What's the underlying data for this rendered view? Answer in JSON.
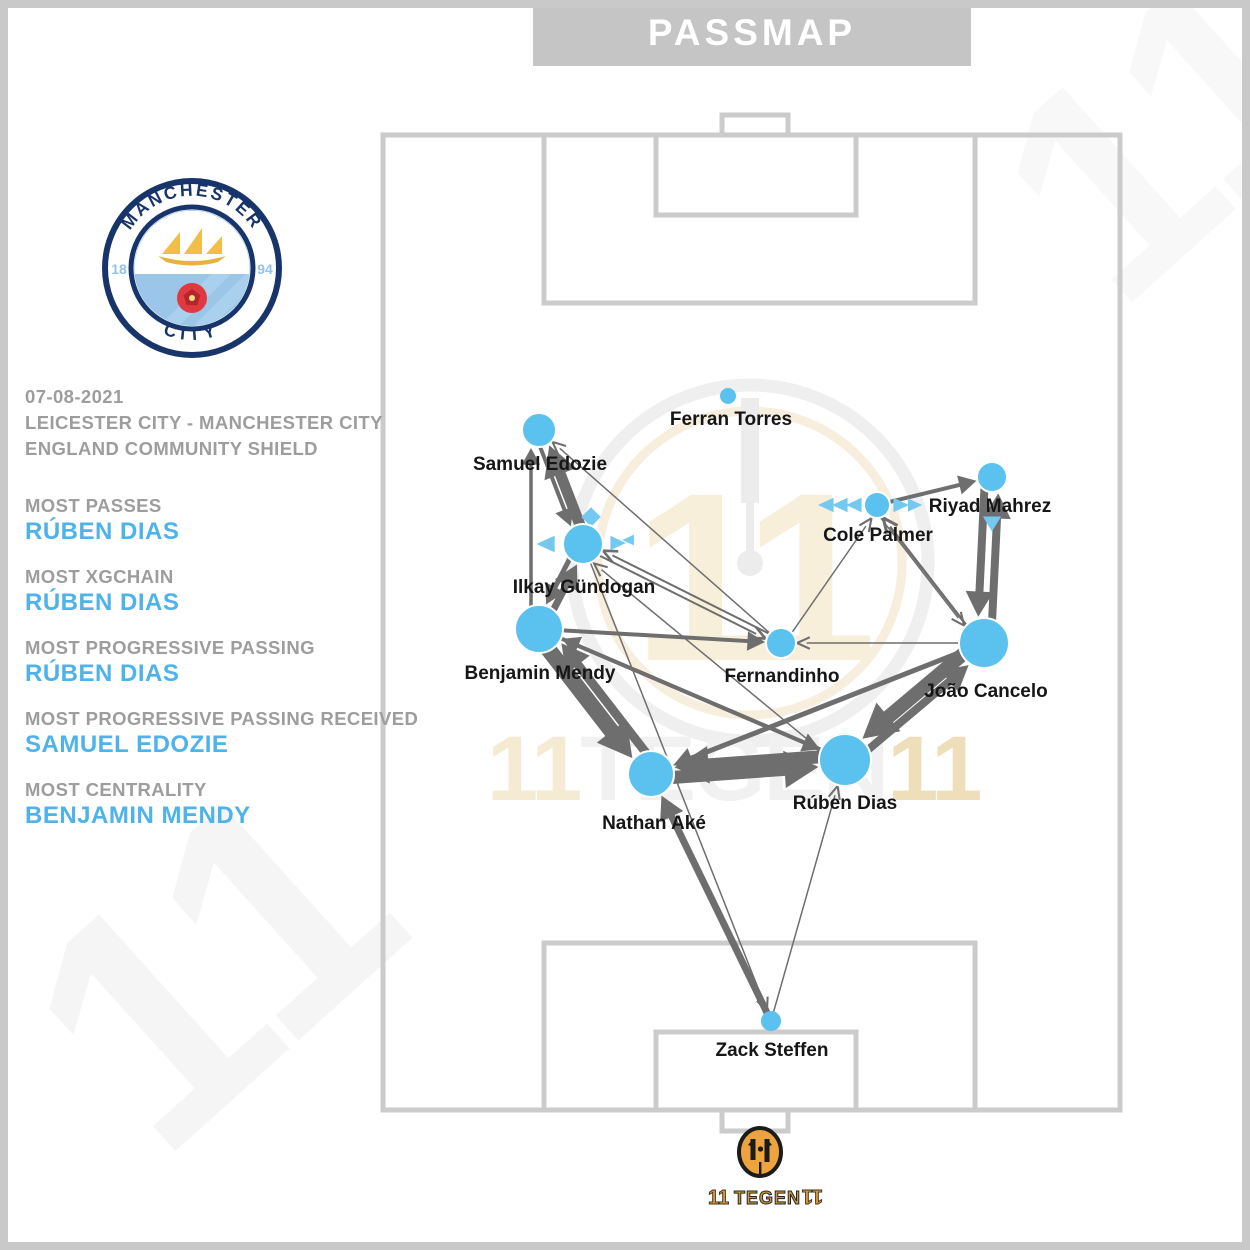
{
  "title_bar": {
    "label": "PASSMAP"
  },
  "club_badge": {
    "top_text": "MANCHESTER",
    "bottom_text": "CITY",
    "year_left": "18",
    "year_right": "94",
    "navy": "#17356B",
    "sky": "#9CC6E8"
  },
  "sidebar": {
    "date": "07-08-2021",
    "fixture": "LEICESTER CITY - MANCHESTER CITY",
    "competition": "ENGLAND COMMUNITY SHIELD",
    "label_color": "#9D9D9D",
    "accent_color": "#4DB3EA",
    "stats": [
      {
        "label": "MOST PASSES",
        "value": "RÚBEN DIAS"
      },
      {
        "label": "MOST XGCHAIN",
        "value": "RÚBEN DIAS"
      },
      {
        "label": "MOST PROGRESSIVE PASSING",
        "value": "RÚBEN DIAS"
      },
      {
        "label": "MOST PROGRESSIVE PASSING RECEIVED",
        "value": "SAMUEL EDOZIE"
      },
      {
        "label": "MOST CENTRALITY",
        "value": "BENJAMIN MENDY"
      }
    ]
  },
  "watermark": {
    "band_left": "11",
    "band_mid": "TEGEN",
    "band_right": "11",
    "corner": "11"
  },
  "footer_brand": {
    "first": "11",
    "mid": "TEGEN",
    "last": "11"
  },
  "chart_data": {
    "type": "scatter",
    "subtype": "pass-network",
    "title": "PASSMAP",
    "team": "Manchester City",
    "node_color": "#5BC1EE",
    "edge_color": "#6E6E6E",
    "marker_color": "#74C9F1",
    "pitch_line_color": "#CBCBCB",
    "players": [
      {
        "id": "torres",
        "name": "Ferran Torres",
        "x": 728,
        "y": 396,
        "r": 8,
        "lx": 731,
        "ly": 425
      },
      {
        "id": "edozie",
        "name": "Samuel Edozie",
        "x": 539,
        "y": 430,
        "r": 17,
        "lx": 540,
        "ly": 470
      },
      {
        "id": "gundogan",
        "name": "Ilkay Gündogan",
        "x": 583,
        "y": 544,
        "r": 20,
        "lx": 584,
        "ly": 593
      },
      {
        "id": "mendy",
        "name": "Benjamin Mendy",
        "x": 539,
        "y": 629,
        "r": 24,
        "lx": 540,
        "ly": 679
      },
      {
        "id": "fernandinho",
        "name": "Fernandinho",
        "x": 781,
        "y": 643,
        "r": 15,
        "lx": 782,
        "ly": 682
      },
      {
        "id": "palmer",
        "name": "Cole Palmer",
        "x": 877,
        "y": 505,
        "r": 13,
        "lx": 878,
        "ly": 541
      },
      {
        "id": "mahrez",
        "name": "Riyad Mahrez",
        "x": 992,
        "y": 477,
        "r": 15,
        "lx": 990,
        "ly": 512
      },
      {
        "id": "cancelo",
        "name": "João Cancelo",
        "x": 984,
        "y": 643,
        "r": 25,
        "lx": 986,
        "ly": 697
      },
      {
        "id": "ake",
        "name": "Nathan Aké",
        "x": 651,
        "y": 774,
        "r": 23,
        "lx": 654,
        "ly": 829
      },
      {
        "id": "dias",
        "name": "Rúben Dias",
        "x": 845,
        "y": 760,
        "r": 26,
        "lx": 845,
        "ly": 809
      },
      {
        "id": "steffen",
        "name": "Zack Steffen",
        "x": 771,
        "y": 1021,
        "r": 10,
        "lx": 772,
        "ly": 1056
      }
    ],
    "edges": [
      {
        "from": "gundogan",
        "to": "edozie",
        "w": 11,
        "off": 4
      },
      {
        "from": "edozie",
        "to": "gundogan",
        "w": 4,
        "off": 5
      },
      {
        "from": "mendy",
        "to": "edozie",
        "w": 3.5,
        "off": -8
      },
      {
        "from": "mendy",
        "to": "gundogan",
        "w": 7,
        "off": 4
      },
      {
        "from": "gundogan",
        "to": "mendy",
        "w": 5,
        "off": 5
      },
      {
        "from": "mendy",
        "to": "ake",
        "w": 16,
        "off": 5
      },
      {
        "from": "ake",
        "to": "mendy",
        "w": 9,
        "off": 9
      },
      {
        "from": "ake",
        "to": "dias",
        "w": 13,
        "off": 5
      },
      {
        "from": "dias",
        "to": "ake",
        "w": 13,
        "off": 5
      },
      {
        "from": "cancelo",
        "to": "dias",
        "w": 14,
        "off": 5
      },
      {
        "from": "dias",
        "to": "cancelo",
        "w": 8,
        "off": 7
      },
      {
        "from": "cancelo",
        "to": "mahrez",
        "w": 8,
        "off": 7
      },
      {
        "from": "mahrez",
        "to": "cancelo",
        "w": 8,
        "off": 7
      },
      {
        "from": "steffen",
        "to": "ake",
        "w": 7,
        "off": 0
      },
      {
        "from": "steffen",
        "to": "dias",
        "w": 1.5,
        "off": 0
      },
      {
        "from": "gundogan",
        "to": "steffen",
        "w": 1.5,
        "off": 0
      },
      {
        "from": "mendy",
        "to": "fernandinho",
        "w": 4,
        "off": 0
      },
      {
        "from": "dias",
        "to": "mendy",
        "w": 4,
        "off": 0
      },
      {
        "from": "cancelo",
        "to": "ake",
        "w": 5,
        "off": 0
      },
      {
        "from": "mendy",
        "to": "dias",
        "w": 4,
        "off": 0
      },
      {
        "from": "gundogan",
        "to": "fernandinho",
        "w": 2,
        "off": 3
      },
      {
        "from": "fernandinho",
        "to": "gundogan",
        "w": 2,
        "off": 3
      },
      {
        "from": "dias",
        "to": "gundogan",
        "w": 1.5,
        "off": -8
      },
      {
        "from": "fernandinho",
        "to": "edozie",
        "w": 1.5,
        "off": 0
      },
      {
        "from": "cancelo",
        "to": "fernandinho",
        "w": 1.5,
        "off": 0
      },
      {
        "from": "fernandinho",
        "to": "palmer",
        "w": 1.5,
        "off": 3
      },
      {
        "from": "cancelo",
        "to": "palmer",
        "w": 2.5,
        "off": -3
      },
      {
        "from": "palmer",
        "to": "mahrez",
        "w": 4,
        "off": 0
      },
      {
        "from": "palmer",
        "to": "cancelo",
        "w": 1.5,
        "off": 5
      }
    ],
    "pass_direction_markers": [
      {
        "shape": "left",
        "x": 547,
        "y": 544,
        "s": 14
      },
      {
        "shape": "diamond",
        "x": 591,
        "y": 517,
        "s": 13
      },
      {
        "shape": "right",
        "x": 617,
        "y": 543,
        "s": 12
      },
      {
        "shape": "left",
        "x": 629,
        "y": 540,
        "s": 9
      },
      {
        "shape": "left",
        "x": 827,
        "y": 505,
        "s": 12
      },
      {
        "shape": "left",
        "x": 841,
        "y": 505,
        "s": 12
      },
      {
        "shape": "left",
        "x": 855,
        "y": 505,
        "s": 12
      },
      {
        "shape": "right",
        "x": 900,
        "y": 505,
        "s": 12
      },
      {
        "shape": "right",
        "x": 914,
        "y": 505,
        "s": 11
      },
      {
        "shape": "down",
        "x": 992,
        "y": 523,
        "s": 13
      }
    ]
  }
}
